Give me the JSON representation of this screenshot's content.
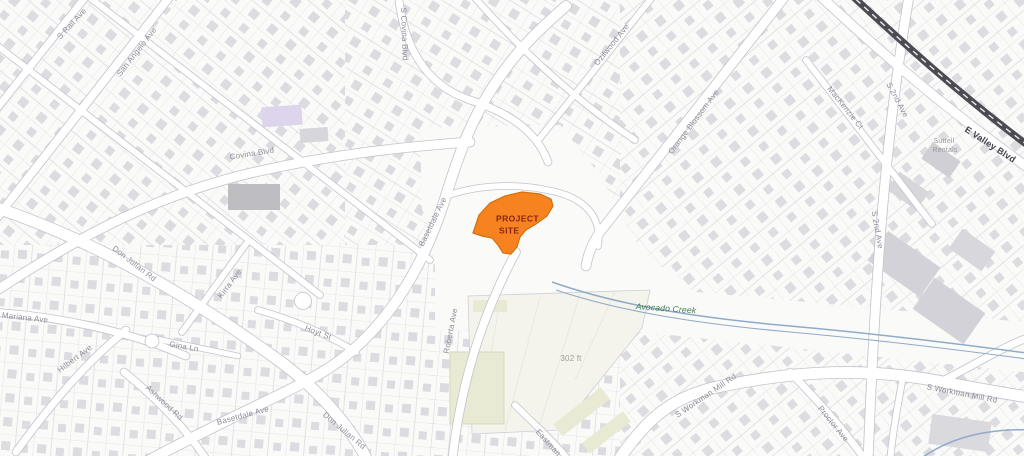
{
  "map": {
    "colors": {
      "bg": "#fafaf8",
      "road_fill": "#ffffff",
      "road_casing": "#c3c3cc",
      "parcel_line": "#cfcfd8",
      "building": "#d9d9de",
      "khaki_parcel": "#f4f4ec",
      "khaki_building": "#e9ead3",
      "railroad": "#4b4b52",
      "creek": "#90abc9",
      "creek_label": "#3e7b52",
      "street_label": "#8e8e9a",
      "street_label_major": "#44444c",
      "poi_label": "#9a9a9c",
      "muted_label": "#9e9e94",
      "project_fill": "#F6831F",
      "project_stroke": "#D4700A",
      "project_label": "#8a2410"
    },
    "project_site": {
      "label_line1": "PROJECT",
      "label_line2": "SITE"
    },
    "scale_note": "302 ft",
    "labels": [
      {
        "n": "s-rail-ave-label",
        "t": "S Rail Ave",
        "x": 72,
        "y": 24,
        "r": -47,
        "c": ""
      },
      {
        "n": "san-angelo-ave-label",
        "t": "San Angelo Ave",
        "x": 137,
        "y": 52,
        "r": -52,
        "c": ""
      },
      {
        "n": "covina-blvd-label",
        "t": "Covina Blvd",
        "x": 252,
        "y": 154,
        "r": -9,
        "c": ""
      },
      {
        "n": "s-covina-blvd-label",
        "t": "S Covina Blvd",
        "x": 404,
        "y": 34,
        "r": 88,
        "c": ""
      },
      {
        "n": "ozilwood-ave-label",
        "t": "Ozilwood Ave",
        "x": 612,
        "y": 45,
        "r": -51,
        "c": ""
      },
      {
        "n": "orange-blossom-ave-label",
        "t": "Orange Blossom Ave",
        "x": 694,
        "y": 122,
        "r": -53,
        "c": ""
      },
      {
        "n": "mackenzie-ct-label",
        "t": "MacKenzie Ct",
        "x": 845,
        "y": 108,
        "r": 51,
        "c": ""
      },
      {
        "n": "s-2nd-ave-top-label",
        "t": "S 2nd Ave",
        "x": 897,
        "y": 100,
        "r": 62,
        "c": ""
      },
      {
        "n": "suttell-rentals-label-1",
        "t": "Suttell",
        "x": 944,
        "y": 141,
        "r": 0,
        "c": "poi"
      },
      {
        "n": "suttell-rentals-label-2",
        "t": "Rentals",
        "x": 945,
        "y": 150,
        "r": 0,
        "c": "poi"
      },
      {
        "n": "e-valley-blvd-label",
        "t": "E Valley Blvd",
        "x": 990,
        "y": 145,
        "r": 33,
        "c": "major"
      },
      {
        "n": "s-2nd-ave-mid-label",
        "t": "S 2nd Ave",
        "x": 877,
        "y": 230,
        "r": 80,
        "c": ""
      },
      {
        "n": "basetdale-ave-label",
        "t": "Basetdale Ave",
        "x": 433,
        "y": 222,
        "r": -64,
        "c": ""
      },
      {
        "n": "basetdale-ave-south-label",
        "t": "Basetdale Ave",
        "x": 243,
        "y": 416,
        "r": -15,
        "c": ""
      },
      {
        "n": "don-julian-rd-label",
        "t": "Don Julian Rd",
        "x": 134,
        "y": 264,
        "r": 38,
        "c": ""
      },
      {
        "n": "don-julian-rd-south-label",
        "t": "Don Julian Rd",
        "x": 344,
        "y": 431,
        "r": 40,
        "c": ""
      },
      {
        "n": "mariana-ave-label",
        "t": "Mariana Ave",
        "x": 25,
        "y": 318,
        "r": 6,
        "c": ""
      },
      {
        "n": "hilbert-ave-label",
        "t": "Hilbert Ave",
        "x": 75,
        "y": 359,
        "r": -37,
        "c": ""
      },
      {
        "n": "ashwood-rd-label",
        "t": "Ashwood Rd",
        "x": 164,
        "y": 403,
        "r": 43,
        "c": ""
      },
      {
        "n": "kirra-ave-label",
        "t": "Kirra Ave",
        "x": 230,
        "y": 284,
        "r": -53,
        "c": ""
      },
      {
        "n": "hoyt-st-label",
        "t": "Hoyt St",
        "x": 318,
        "y": 333,
        "r": 21,
        "c": ""
      },
      {
        "n": "gina-ln-label",
        "t": "Gina Ln",
        "x": 184,
        "y": 347,
        "r": 10,
        "c": ""
      },
      {
        "n": "roberta-ave-label",
        "t": "Roberta Ave",
        "x": 451,
        "y": 331,
        "r": -79,
        "c": ""
      },
      {
        "n": "s-workman-mill-rd-west-label",
        "t": "S Workman Mill Rd",
        "x": 706,
        "y": 396,
        "r": -34,
        "c": ""
      },
      {
        "n": "s-workman-mill-rd-east-label",
        "t": "S Workman Mill Rd",
        "x": 962,
        "y": 394,
        "r": 11,
        "c": ""
      },
      {
        "n": "proctor-ave-label",
        "t": "Proctor Ave",
        "x": 833,
        "y": 424,
        "r": 51,
        "c": ""
      },
      {
        "n": "eastman-label",
        "t": "Eastman",
        "x": 548,
        "y": 443,
        "r": 48,
        "c": ""
      },
      {
        "n": "avocado-creek-label",
        "t": "Avocado Creek",
        "x": 666,
        "y": 309,
        "r": 4,
        "c": "creek"
      },
      {
        "n": "distance-302ft-label",
        "t": "302 ft",
        "x": 571,
        "y": 359,
        "r": 0,
        "c": "muted"
      },
      {
        "n": "project-site-label-1",
        "t": "PROJECT",
        "x": 496,
        "y": 219,
        "r": 0,
        "c": "proj",
        "a": "start"
      },
      {
        "n": "project-site-label-2",
        "t": "SITE",
        "x": 499,
        "y": 231,
        "r": 0,
        "c": "proj",
        "a": "start"
      }
    ]
  }
}
